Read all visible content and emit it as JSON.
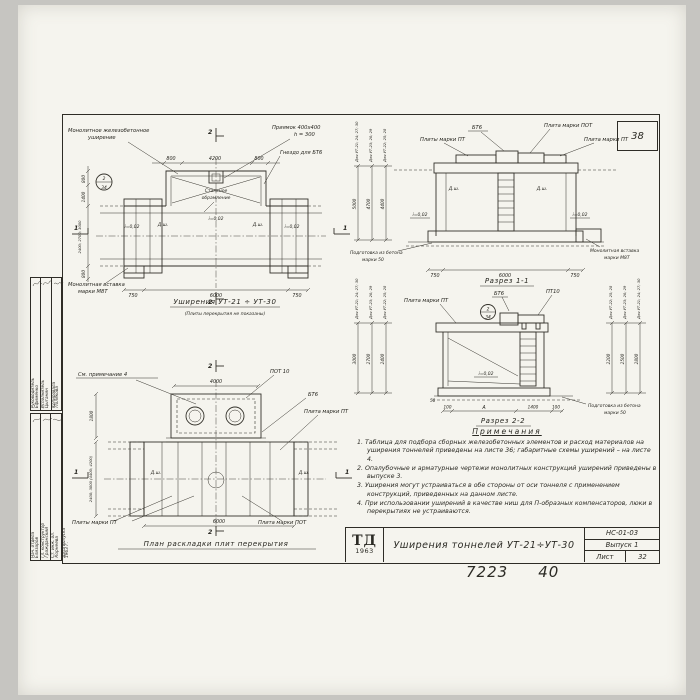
{
  "page": {
    "corner_number": "38",
    "doc_number_left": "7223",
    "doc_number_right": "40"
  },
  "stamp": {
    "rows_top": [
      {
        "role": "Руководитель",
        "name": "Ефименко"
      },
      {
        "role": "Исполнитель",
        "name": "Цыганин"
      },
      {
        "role": "Копировала",
        "name": "Полякова"
      }
    ],
    "rows_bottom": [
      {
        "role": "Нач. отдела",
        "name": "Елизаров"
      },
      {
        "role": "Гл. конструктор",
        "name": "Гражданский"
      },
      {
        "role": "Ст. инж. ол.",
        "name": "Корнеева"
      },
      {
        "role": "Дата выпуска",
        "name": "1963 г."
      }
    ]
  },
  "plan_top": {
    "title": "Уширения УТ-21 ÷ УТ-30",
    "subtitle": "(Плиты перекрытия не показаны)",
    "label_widening_1": "Монолитное железобетонное",
    "label_widening_2": "уширение",
    "label_pit_1": "Приямок 400х400",
    "label_pit_2": "h = 300",
    "label_socket": "Гнездо для БТ6",
    "label_steel_1": "Стальное",
    "label_steel_2": "обрамление",
    "label_insert_1": "Монолитная вставка",
    "label_insert_2": "марки М8Т",
    "slope": "i=0,02",
    "joint": "Д.ш.",
    "callout_top": "2",
    "callout_bottom": "34",
    "dim_top_left": "800",
    "dim_top_mid": "4200",
    "dim_top_right": "800",
    "dim_bottom_left": "750",
    "dim_bottom_mid": "6000",
    "dim_bottom_right": "750",
    "dim_left_1": "800",
    "dim_left_2": "1400",
    "dim_left_3": "2400; 2700; 3000",
    "dim_left_4": "800",
    "mark_1": "1",
    "mark_2": "2"
  },
  "section1": {
    "title": "Разрез 1-1",
    "label_bt6": "БТ6",
    "label_pot": "Плита марки ПОТ",
    "label_pt_left": "Плиты марки ПТ",
    "label_pt_right": "Плита марки ПТ",
    "label_prep_1": "Подготовка из бетона",
    "label_prep_2": "марки 50",
    "label_insert_1": "Монолитная вставка",
    "label_insert_2": "марки М8Т",
    "slope": "i=0,02",
    "joint": "Д.ш.",
    "for_1": "Для УТ-21; 24; 27; 30",
    "for_2": "Для УТ-23; 26; 29",
    "for_3": "Для УТ-22; 25; 28",
    "dim_v1": "5000",
    "dim_v2": "4700",
    "dim_v3": "4400",
    "dim_bottom_left": "750",
    "dim_bottom_mid": "6000",
    "dim_bottom_right": "750"
  },
  "section2": {
    "title": "Разрез 2-2",
    "label_pt": "Плита марки ПТ",
    "label_bt6": "БТ6",
    "label_pt10": "ПТ10",
    "callout_top": "2",
    "callout_bottom": "34",
    "slope": "i=0,02",
    "label_prep_1": "Подготовка из бетона",
    "label_prep_2": "марки 50",
    "for_1": "Для УТ-21; 24; 27; 30",
    "for_2": "Для УТ-23; 26; 29",
    "for_3": "Для УТ-22; 25; 28",
    "dim_left_1": "3000",
    "dim_left_2": "2700",
    "dim_left_3": "2400",
    "dim_right_1": "2200",
    "dim_right_2": "2500",
    "dim_right_3": "2800",
    "dim_b1": "100",
    "dim_b2": "А",
    "dim_b3": "1400",
    "dim_b4": "100",
    "dim_50": "50"
  },
  "plan_bottom": {
    "title": "План раскладки плит перекрытия",
    "label_note": "См. примечание 4",
    "label_pot10": "ПОТ 10",
    "label_bt6": "БТ6",
    "label_pt": "Плита марки ПТ",
    "label_pt_bottom": "Плиты марки ПТ",
    "label_pot": "Плита марки ПОТ",
    "joint": "Д.ш.",
    "dim_top": "4000",
    "dim_left_1": "1800",
    "dim_left_2": "2400; 3000 (4400; 4200)",
    "dim_bottom": "6000",
    "mark_1": "1",
    "mark_2": "2"
  },
  "notes": {
    "heading": "Примечания",
    "items": [
      "1. Таблица для подбора сборных железобетонных элементов и расход материалов на уширения тоннелей приведены на листе 36; габаритные схемы уширений – на листе 4.",
      "2. Опалубочные и арматурные чертежи монолитных конструкций уширений приведены в выпуске 3.",
      "3. Уширения могут устраиваться в обе стороны от оси тоннеля с применением конструкций, приведенных на данном листе.",
      "4. При использовании уширений в качестве ниш для П-образных компенсаторов, люки в перекрытиях не устраиваются."
    ]
  },
  "titleblock": {
    "logo_top": "ТД",
    "logo_year": "1963",
    "title": "Уширения тоннелей УТ-21÷УТ-30",
    "code": "НС-01-03",
    "issue": "Выпуск 1",
    "sheet_label": "Лист",
    "sheet_number": "32"
  }
}
